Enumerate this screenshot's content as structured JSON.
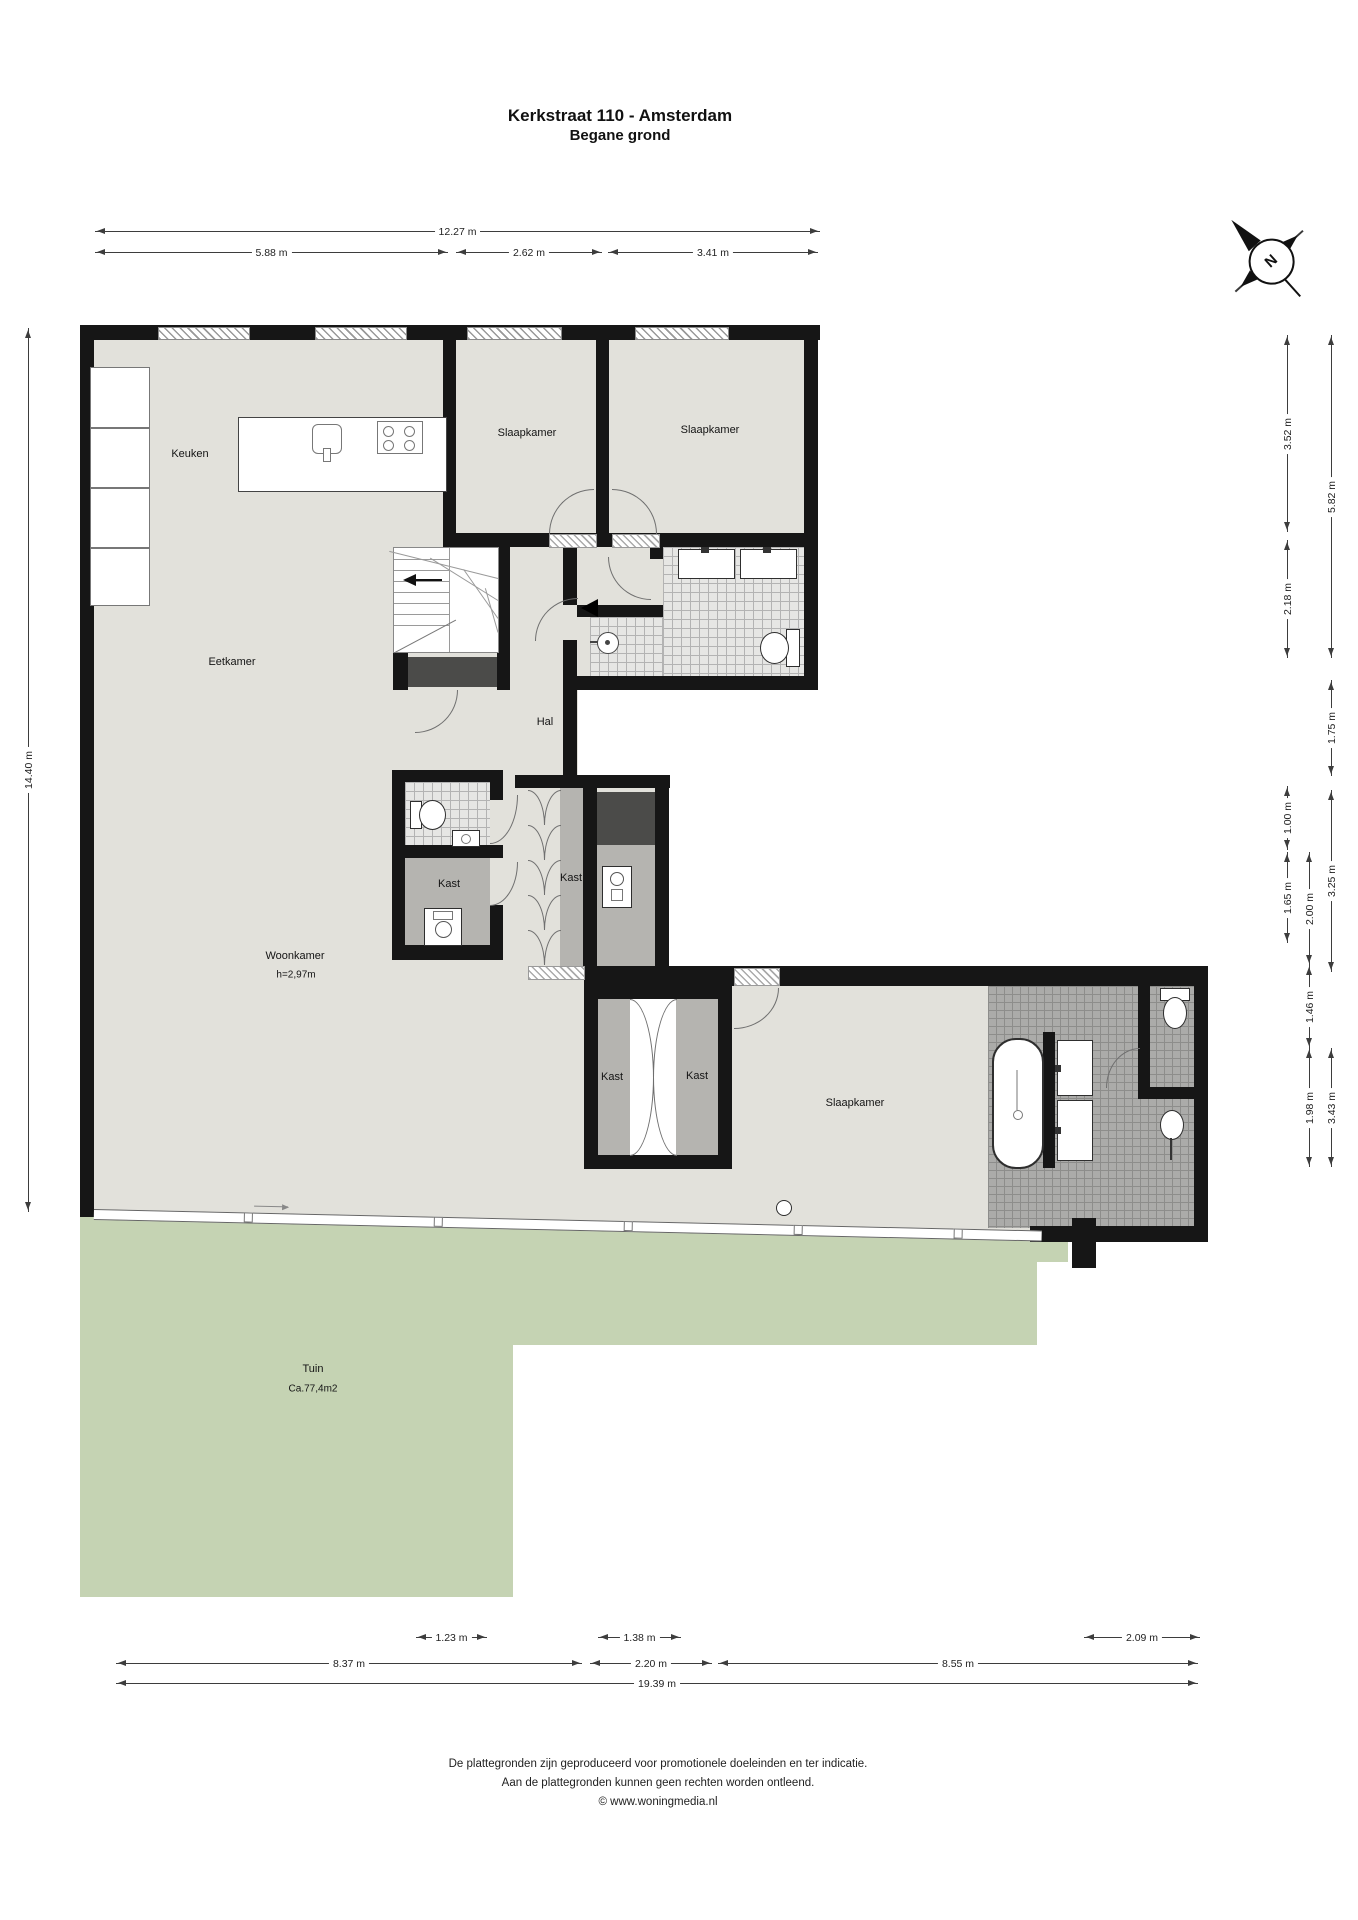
{
  "title": {
    "line1": "Kerkstraat 110 - Amsterdam",
    "line2": "Begane grond"
  },
  "compass": {
    "letter": "N"
  },
  "rooms": {
    "keuken": "Keuken",
    "slaapkamer1": "Slaapkamer",
    "slaapkamer2": "Slaapkamer",
    "eetkamer": "Eetkamer",
    "hal": "Hal",
    "kast_utility": "Kast",
    "kast_hall": "Kast",
    "kast_left": "Kast",
    "kast_right": "Kast",
    "woonkamer": "Woonkamer",
    "woonkamer_height": "h=2,97m",
    "slaapkamer3": "Slaapkamer",
    "tuin": "Tuin",
    "tuin_area": "Ca.77,4m2"
  },
  "dimensions": {
    "top": [
      "12.27 m",
      "5.88 m",
      "2.62 m",
      "3.41 m"
    ],
    "left": [
      "14.40 m"
    ],
    "right": [
      "3.52 m",
      "2.18 m",
      "1.00 m",
      "1.65 m",
      "2.00 m",
      "1.46 m",
      "1.98 m",
      "5.82 m",
      "1.75 m",
      "3.25 m",
      "3.43 m"
    ],
    "bottom": [
      "1.23 m",
      "1.38 m",
      "2.09 m",
      "8.37 m",
      "2.20 m",
      "8.55 m",
      "19.39 m"
    ]
  },
  "colors": {
    "floor": "#e2e1db",
    "garden": "#c5d3b3",
    "wall": "#161616",
    "closet": "#b5b4b0"
  },
  "footer": {
    "line1": "De plattegronden zijn geproduceerd voor promotionele doeleinden en ter indicatie.",
    "line2": "Aan de plattegronden kunnen geen rechten worden ontleend.",
    "line3": "© www.woningmedia.nl"
  }
}
